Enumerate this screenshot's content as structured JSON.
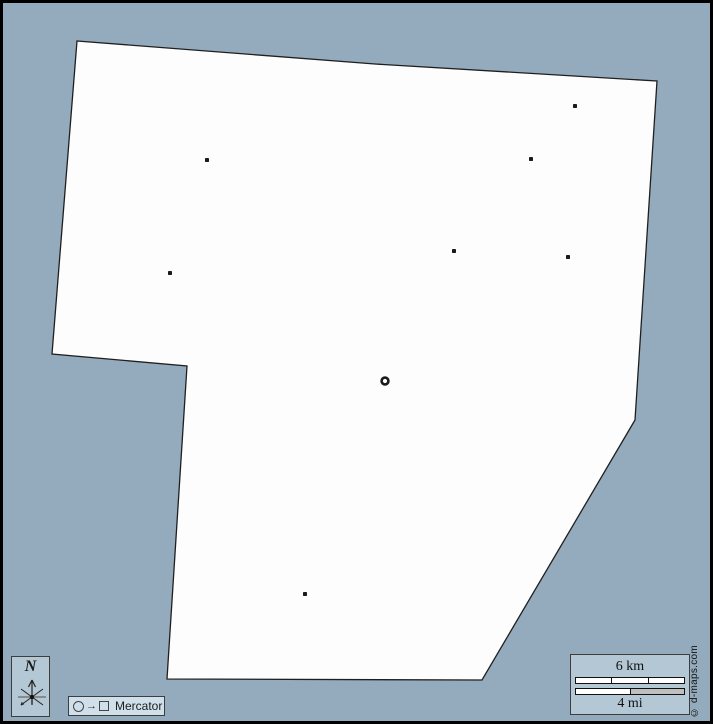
{
  "canvas": {
    "width": 713,
    "height": 724,
    "sea_color": "#94abbd",
    "land_color": "#fdfdfd",
    "outline_color": "#1f1f1f",
    "panel_color": "#b3c8d4",
    "panel_light_color": "#cfe0ea",
    "marker_color": "#1a1a1a"
  },
  "map": {
    "territory_polygon": [
      [
        77,
        41
      ],
      [
        375,
        64
      ],
      [
        657,
        81
      ],
      [
        635,
        420
      ],
      [
        482,
        680
      ],
      [
        167,
        679
      ],
      [
        187,
        366
      ],
      [
        52,
        354
      ]
    ],
    "city_dots": [
      [
        575,
        106
      ],
      [
        207,
        160
      ],
      [
        531,
        159
      ],
      [
        454,
        251
      ],
      [
        568,
        257
      ],
      [
        170,
        273
      ],
      [
        305,
        594
      ]
    ],
    "capital_ring": {
      "x": 385,
      "y": 381
    }
  },
  "compass": {
    "label": "N"
  },
  "projection": {
    "label": "Mercator",
    "legend_arrow": "→"
  },
  "scale_bar": {
    "km_label": "6 km",
    "mi_label": "4 mi",
    "km_segments": 3,
    "mi_segments": 2
  },
  "copyright": "© d-maps.com"
}
